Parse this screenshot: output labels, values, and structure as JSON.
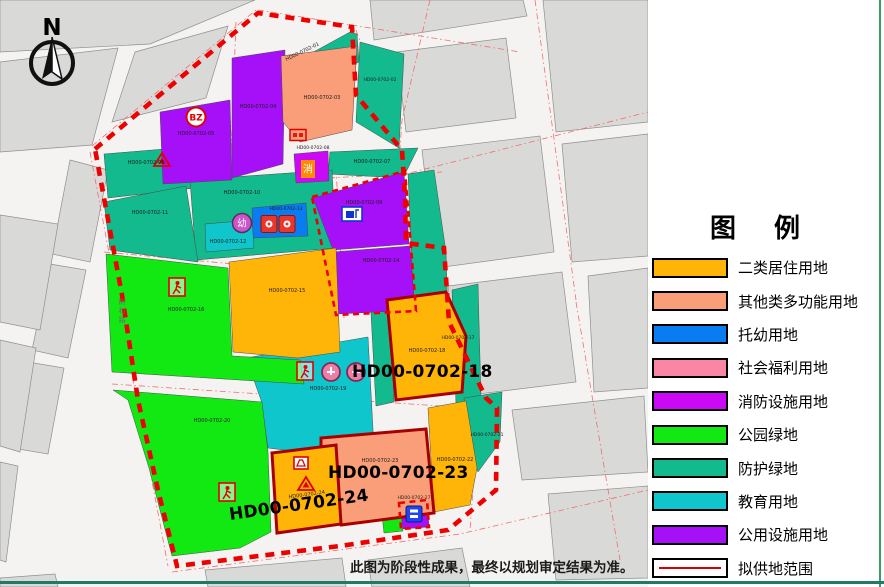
{
  "legend": {
    "title": "图　例",
    "items": [
      {
        "label": "二类居住用地",
        "color": "#FFB408"
      },
      {
        "label": "其他类多功能用地",
        "color": "#F99E78"
      },
      {
        "label": "托幼用地",
        "color": "#0A7CF2"
      },
      {
        "label": "社会福利用地",
        "color": "#FA85A5"
      },
      {
        "label": "消防设施用地",
        "color": "#CB0AF5"
      },
      {
        "label": "公园绿地",
        "color": "#12E912"
      },
      {
        "label": "防护绿地",
        "color": "#12BA8E"
      },
      {
        "label": "教育用地",
        "color": "#0FC6CC"
      },
      {
        "label": "公用设施用地",
        "color": "#A610F8"
      },
      {
        "label": "拟供地范围",
        "color": "#D80000"
      }
    ]
  },
  "map": {
    "north_label": "N",
    "road_name": "树村路",
    "badges": {
      "bz": "BZ",
      "fire": "消",
      "kindergarten": "幼"
    },
    "parcels": [
      {
        "label": "HD00-0702-01",
        "use": "防护绿地"
      },
      {
        "label": "HD00-0702-02",
        "use": "防护绿地"
      },
      {
        "label": "HD00-0702-03",
        "use": "其他类多功能用地"
      },
      {
        "label": "HD00-0702-04",
        "use": "公用设施用地"
      },
      {
        "label": "HD00-0702-05",
        "use": "公用设施用地"
      },
      {
        "label": "HD00-0702-06",
        "use": "防护绿地"
      },
      {
        "label": "HD00-0702-07",
        "use": "防护绿地"
      },
      {
        "label": "HD00-0702-08",
        "use": "消防设施用地"
      },
      {
        "label": "HD00-0702-09",
        "use": "公用设施用地"
      },
      {
        "label": "HD00-0702-10",
        "use": "防护绿地"
      },
      {
        "label": "HD00-0702-11",
        "use": "防护绿地"
      },
      {
        "label": "HD00-0702-12",
        "use": "教育用地"
      },
      {
        "label": "HD00-0702-13",
        "use": "托幼用地"
      },
      {
        "label": "HD00-0702-14",
        "use": "公用设施用地"
      },
      {
        "label": "HD00-0702-15",
        "use": "二类居住用地"
      },
      {
        "label": "HD00-0702-16",
        "use": "公园绿地"
      },
      {
        "label": "HD00-0702-17",
        "use": "防护绿地"
      },
      {
        "label": "HD00-0702-18",
        "use": "二类居住用地"
      },
      {
        "label": "HD00-0702-19",
        "use": "教育用地"
      },
      {
        "label": "HD00-0702-20",
        "use": "公园绿地"
      },
      {
        "label": "HD00-0702-21",
        "use": "防护绿地"
      },
      {
        "label": "HD00-0702-22",
        "use": "二类居住用地"
      },
      {
        "label": "HD00-0702-23",
        "use": "其他类多功能用地"
      },
      {
        "label": "HD00-0702-24",
        "use": "二类居住用地"
      },
      {
        "label": "HD00-0702-27",
        "use": "公用设施用地"
      }
    ],
    "big_labels": [
      "HD00-0702-18",
      "HD00-0702-23",
      "HD00-0702-24"
    ]
  },
  "footer": {
    "disclaimer": "此图为阶段性成果，最终以规划审定结果为准。"
  }
}
